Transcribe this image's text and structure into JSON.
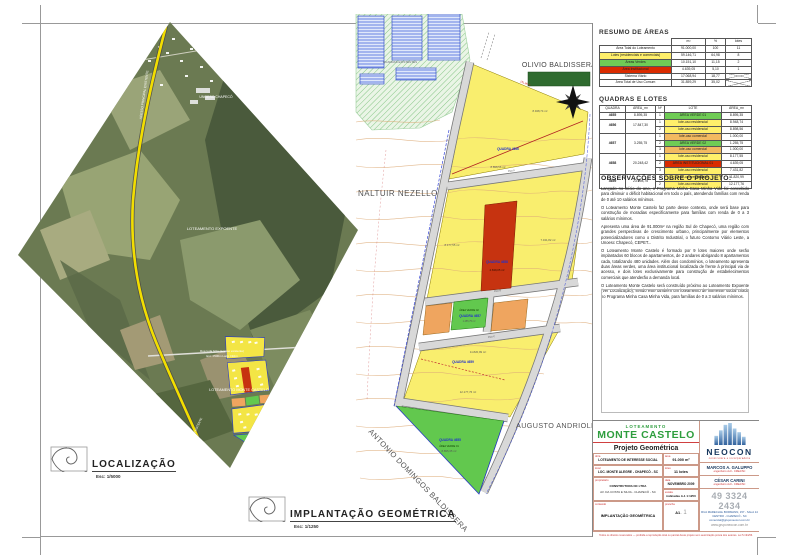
{
  "localizacao": {
    "title": "LOCALIZAÇÃO",
    "scale": "Esc: 1/5000"
  },
  "implantacao": {
    "title": "IMPLANTAÇÃO GEOMÉTRICA",
    "scale": "Esc: 1/1250"
  },
  "satellite": {
    "expoente": "LOTEAMENTO EXPOENTE",
    "unoesc": "UNOESC CHAPECÓ",
    "monte_castelo": "LOTEAMENTO MONTE CASTELO",
    "access_line1": "Rua toda brita (acesso existente)",
    "access_line2": "Ext: ±500m    Larg: ±10m",
    "road_name": "ACESSO PRINCIPAL EXISTENTE",
    "road_name2": "ACESSO EXISTENTE"
  },
  "plan": {
    "neighbor_north": "OLIVIO BALDISSERA",
    "neighbor_west": "NALTUIR NEZELLO",
    "neighbor_east": "AUGUSTO ANDRIOLI",
    "neighbor_south": "ANTONIO DOMINGOS BALDISSERA",
    "existing": "QUADRAS EXISTENTES",
    "q4655": "QUADRA 4655",
    "q4656": "QUADRA 4656",
    "q4657": "QUADRA 4657",
    "q4658": "QUADRA 4658",
    "q4659": "QUADRA 4659",
    "verde01": "ÁREA VERDE 01",
    "verde02": "ÁREA VERDE 02",
    "a4656_1": "8.948,74 m²",
    "a4656_2": "8.898,56 m²",
    "a4658_1": "8.177,55 m²",
    "a4658_2": "4.639,05 m²",
    "a4658_3": "7.431,82 m²",
    "a4659_1": "11.820,99 m²",
    "a4659_2": "12.177,76 m²",
    "a4655_1": "8.895,35 m²",
    "a4657_2": "1.255,75 m²",
    "dim1": "151,96 m",
    "rua_a": "Rua A",
    "rua_b": "Rua B",
    "rua_c": "Rua C"
  },
  "resumo": {
    "title": "RESUMO DE ÁREAS",
    "col_m2": "m²",
    "col_pct": "%",
    "col_lotes": "lotes",
    "rows": [
      {
        "label": "Área Total do Loteamento",
        "m2": "91.000,00",
        "pct": "100",
        "lotes": "11"
      },
      {
        "label": "Lotes (residenciais e comerciais)",
        "m2": "59.146,71",
        "pct": "64,98",
        "lotes": "8"
      },
      {
        "label": "Áreas Verdes",
        "m2": "10.151,10",
        "pct": "11,15",
        "lotes": "2"
      },
      {
        "label": "Área Institucional",
        "m2": "4.639,05",
        "pct": "5,10",
        "lotes": "1"
      },
      {
        "label": "Sistema Viário",
        "m2": "17.068,94",
        "pct": "18,77",
        "lotes": ""
      },
      {
        "label": "Área Total de Uso Comum",
        "m2": "31.859,29",
        "pct": "35,02",
        "lotes": ""
      }
    ]
  },
  "quadras": {
    "title": "QUADRAS E LOTES",
    "h_quadra": "QUADRA",
    "h_area": "ÁREA_m²",
    "h_n": "Nº",
    "h_lote": "LOTE",
    "h_area2": "ÁREA_m²",
    "groups": [
      {
        "quadra": "4655",
        "area": "8.895,35",
        "lots": [
          {
            "n": "1",
            "name": "ÁREA VERDE 01",
            "area": "8.895,35"
          }
        ]
      },
      {
        "quadra": "4656",
        "area": "17.847,30",
        "lots": [
          {
            "n": "1",
            "name": "lote-uso residencial",
            "area": "8.948,74"
          },
          {
            "n": "2",
            "name": "lote-uso residencial",
            "area": "8.898,56"
          }
        ]
      },
      {
        "quadra": "4657",
        "area": "3.255,75",
        "lots": [
          {
            "n": "1",
            "name": "lote-uso comercial",
            "area": "1.000,00"
          },
          {
            "n": "2",
            "name": "ÁREA VERDE 02",
            "area": "1.255,75"
          },
          {
            "n": "3",
            "name": "lote-uso comercial",
            "area": "1.000,00"
          }
        ]
      },
      {
        "quadra": "4658",
        "area": "20.248,42",
        "lots": [
          {
            "n": "1",
            "name": "lote-uso residencial",
            "area": "8.177,55"
          },
          {
            "n": "2",
            "name": "ÁREA INSTITUCIONAL 01",
            "area": "4.639,05"
          },
          {
            "n": "3",
            "name": "lote-uso residencial",
            "area": "7.431,82"
          }
        ]
      },
      {
        "quadra": "4659",
        "area": "23.998,75",
        "lots": [
          {
            "n": "1",
            "name": "lote-uso residencial",
            "area": "11.820,99"
          },
          {
            "n": "2",
            "name": "lote-uso residencial",
            "area": "12.177,76"
          }
        ]
      }
    ]
  },
  "observacoes": {
    "title": "OBSERVAÇÕES SOBRE O PROJETO:",
    "p1": "Lançado no início do ano, o Programa Minha Casa Minha Vida foi concebido para diminuir o déficit habitacional em todo o país, atendendo famílias com renda de 0 até 10 salários mínimos.",
    "p2": "O Loteamento Monte Castelo faz parte desse contexto, onde será base para construção de moradias especificamente para famílias com renda de 0 a 3 salários mínimos.",
    "p3": "Apresenta uma área de 91.000m² na região Sul de Chapecó, uma região com grandes perspectivas de crescimento urbano, principalmente por elementos potencializadores como o Distrito Industrial, o futuro Contorno Viário Leste, a Unoesc Chapecó, CEPET...",
    "p4": "O Loteamento Monte Castelo é formado por 9 lotes maiores onde serão implantados 60 blocos de apartamentos, de 2 andares abrigando 8 apartamentos cada, totalizando 480 unidades. Além dos condomínios, o loteamento apresenta duas áreas verdes, uma área institucional localizada de frente à principal via de acesso, e dois lotes exclusivamente para construção de estabelecimentos comerciais que atenderão a demanda local.",
    "p5": "O Loteamento Monte Castelo será construído próximo ao Loteamento Expoente (Ver Localização), sendo este também um loteamento de interesse social criado no Programa Minha Casa Minha Vida, para famílias de 0 a 3 salários mínimos."
  },
  "titleblock": {
    "tipo": "LOTEAMENTO",
    "nome": "MONTE CASTELO",
    "subtitulo": "Projeto Geométrica",
    "l_obra": "obra",
    "v_obra": "LOTEAMENTO DE INTERESSE SOCIAL",
    "l_area": "área",
    "v_area": "91.000 m²",
    "l_local": "local",
    "v_local": "LOC. MONTE ALEGRE - CHAPECÓ - SC",
    "l_lotes": "lotes",
    "v_lotes": "11 lotes",
    "l_prop": "proprietário",
    "v_prop": "CONSTRUTORA NC LTDA",
    "v_prop2": "AV. DA COSTA E SILVA - CHAPECÓ - SC",
    "l_data": "data",
    "v_data": "NOVEMBRO 2009",
    "l_escala": "escala",
    "v_escala": "indicadas A-1 1:1250",
    "l_conteudo": "conteúdo",
    "v_conteudo": "IMPLANTAÇÃO GEOMÉTRICA",
    "l_prancha": "prancha",
    "v_prancha": "A1",
    "v_prancha_sub": ". 1",
    "neocon": {
      "name": "NEOCON",
      "tagline": "construtora e incorporadora",
      "eng1": "MARCOS A. GALUPPO",
      "eng1_sub": "engenheiro civil - CREA/SC",
      "eng2": "CÉSAR CARINI",
      "eng2_sub": "engenheiro civil - CREA/SC",
      "phone": "49 3324 2434",
      "addr1": "RUA MARECHAL BORMANN, 157 - SALA 14",
      "addr2": "CENTRO - CHAPECÓ - SC",
      "email": "comercial@gruponeocon.com.br",
      "site": "www.gruponeocon.com.br"
    },
    "footer": "Todos os direitos reservados — proibida a reprodução total ou parcial deste projeto sem autorização prévia dos autores. Lei 5.194/66."
  }
}
